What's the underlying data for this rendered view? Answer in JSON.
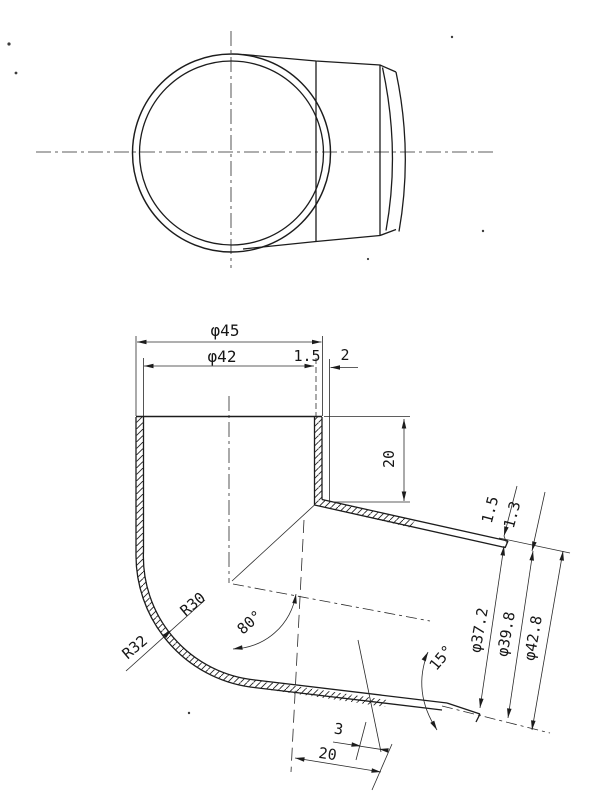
{
  "drawing": {
    "labels": {
      "dia_outer": "φ45",
      "dia_inner": "φ42",
      "wall_top": "1.5",
      "offset_top": "2",
      "socket_depth": "20",
      "bend_r_inner": "R30",
      "bend_r_outer": "R32",
      "bend_angle": "80°",
      "end_wall_a": "1.5",
      "end_wall_b": "1.3",
      "end_dia_1": "φ37.2",
      "end_dia_2": "φ39.8",
      "end_dia_3": "φ42.8",
      "end_taper_angle": "15°",
      "end_len_a": "3",
      "end_len_b": "20"
    }
  }
}
